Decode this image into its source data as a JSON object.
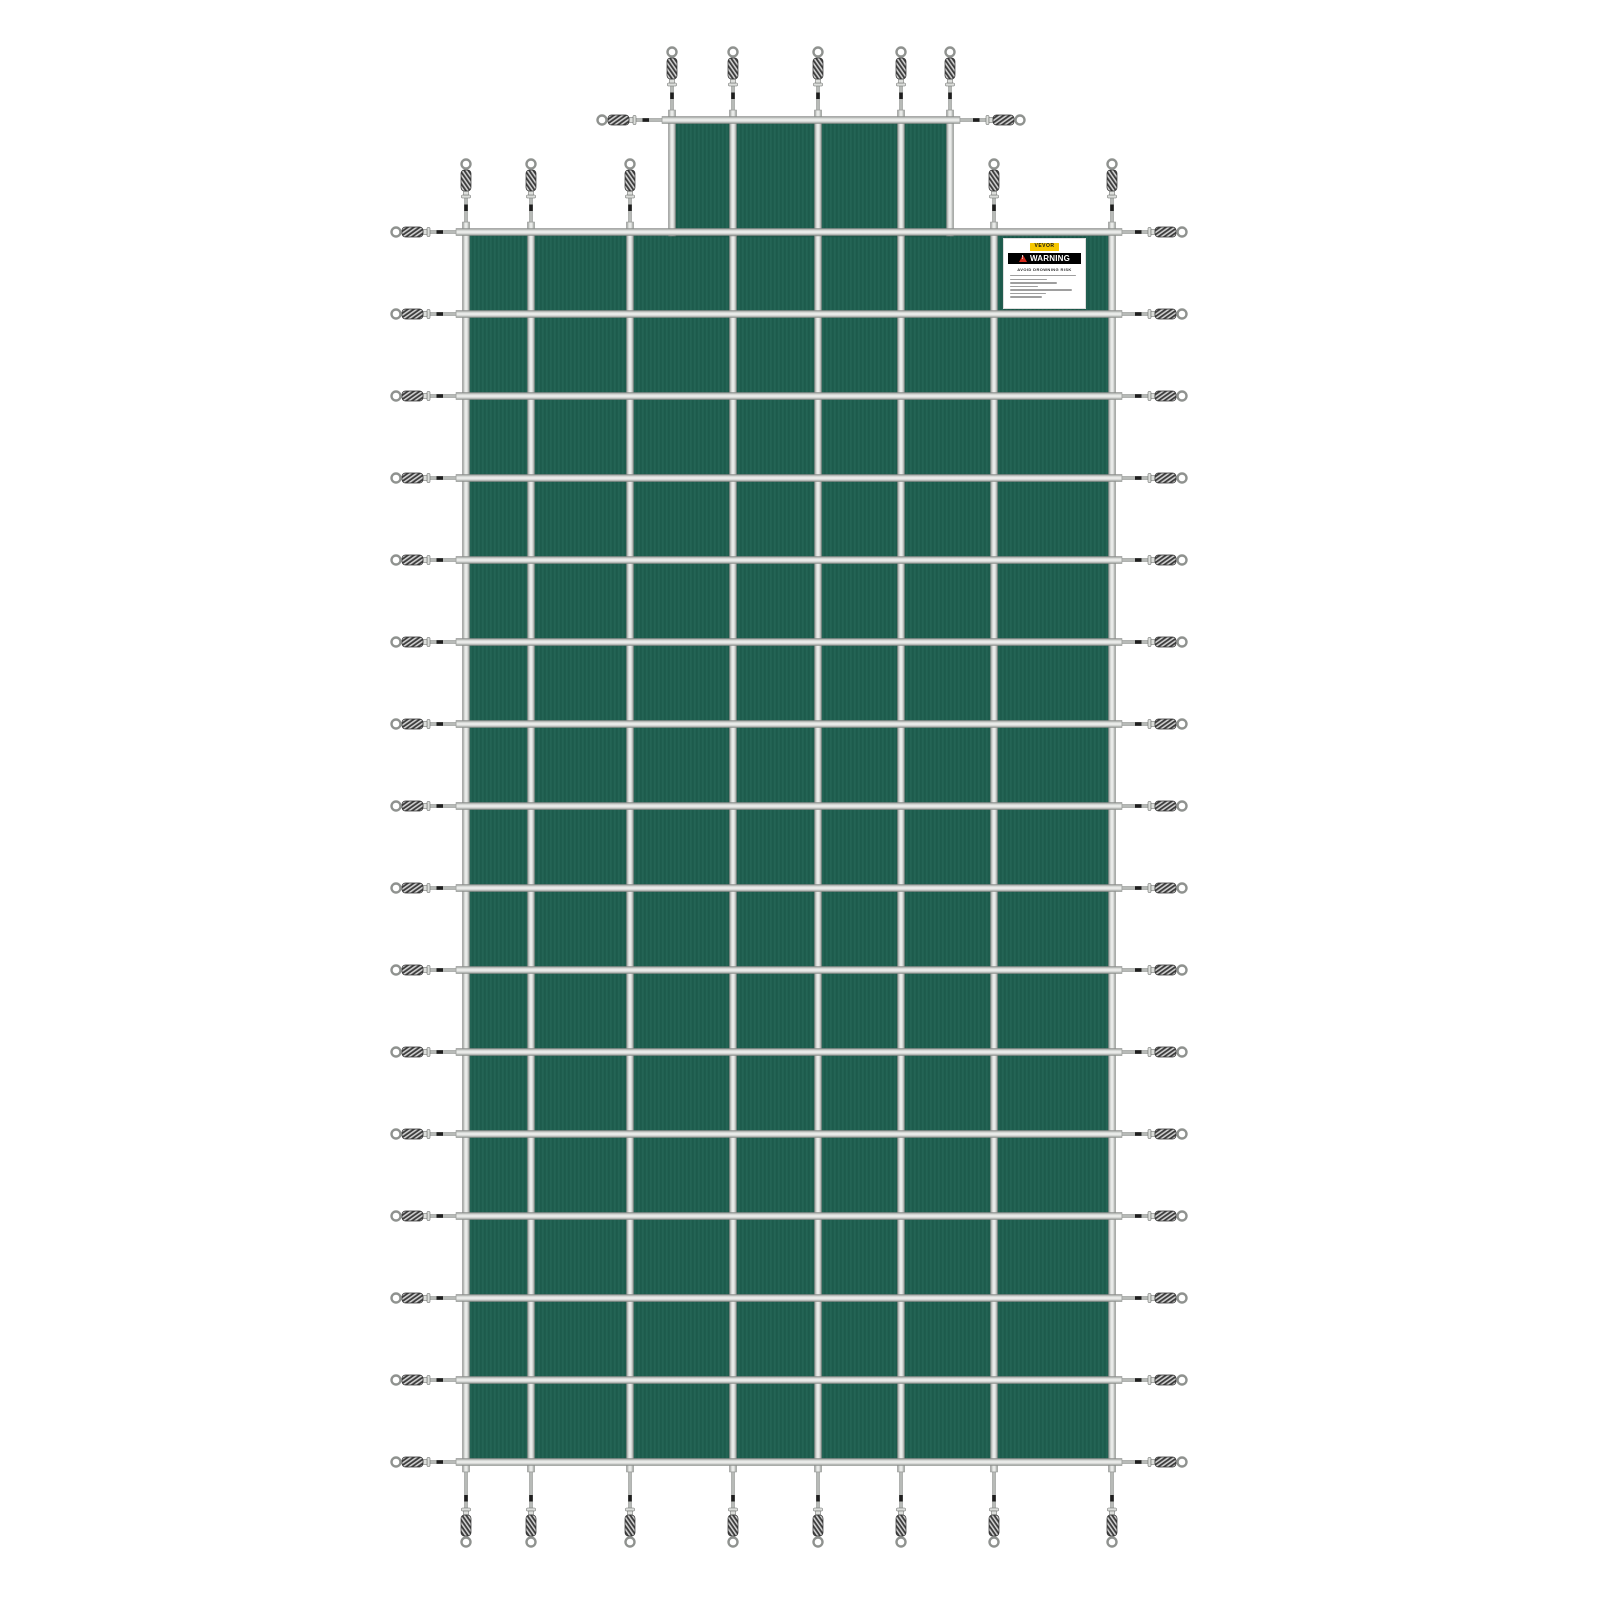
{
  "image": {
    "description": "Green mesh rectangular inground pool safety cover with center step section, gray webbing strap grid and stainless spring anchors extending from every strap end",
    "background_color": "#ffffff"
  },
  "colors": {
    "fabric": "#206152",
    "fabric_stripe_dark": "#1b5748",
    "fabric_stripe_light": "#266757",
    "fabric_hem": "#1a5244",
    "strap_edge": "#898c89",
    "strap_mid": "#cdd0cd",
    "strap_highlight": "#f2f3f1",
    "rod": "#b7bab7",
    "rod_band": "#1e1e1e",
    "coil_dark": "#3c3c3c",
    "coil_light": "#cfcfcf",
    "loop_stroke": "#8f928f",
    "fitting_fill": "#dcdedb",
    "fitting_stroke": "#6e716e"
  },
  "geometry": {
    "main": {
      "x1": 466,
      "x2": 1112,
      "y1": 232,
      "y2": 1462
    },
    "step": {
      "x1": 672,
      "x2": 950,
      "y1": 120
    },
    "vertical_straps": [
      466,
      531,
      630,
      733,
      818,
      901,
      994,
      1112
    ],
    "horizontal_straps": [
      232,
      314,
      396,
      478,
      560,
      642,
      724,
      806,
      888,
      970,
      1052,
      1134,
      1216,
      1298,
      1380,
      1462
    ],
    "step_vertical_straps": [
      672,
      733,
      818,
      901,
      950
    ],
    "top_spring_columns": [
      466,
      531,
      630,
      994,
      1112
    ],
    "strap_width": 7,
    "spring": {
      "rod_len_side": 26,
      "rod_len_top": 24,
      "rod_len_bottom": 36,
      "fitting_len": 7,
      "coil_len": 21,
      "coil_width": 10,
      "loop_radius": 4.5
    },
    "webbing_overhang": 10
  },
  "label": {
    "x": 1003,
    "y": 238,
    "width": 83,
    "height": 71,
    "brand": "VEVOR",
    "brand_bg": "#f6c700",
    "warning_title": "WARNING",
    "warning_bg": "#000000",
    "triangle_color": "#d42b1e",
    "subtitle": "AVOID DROWNING RISK",
    "fine_print_line_widths_pct": [
      96,
      54,
      68,
      40,
      90,
      52,
      46
    ]
  }
}
